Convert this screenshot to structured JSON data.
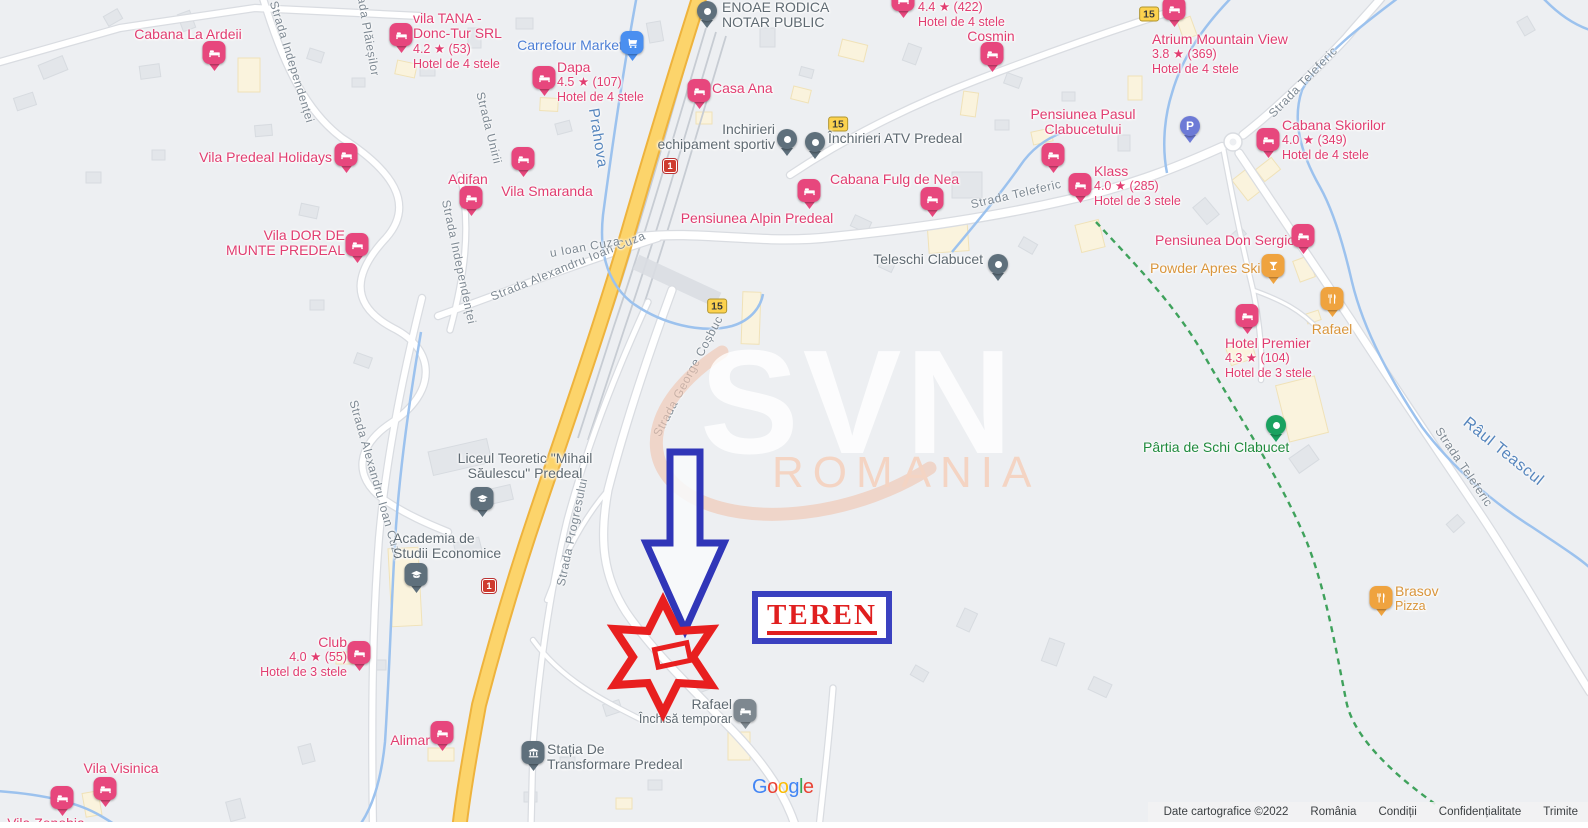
{
  "map": {
    "watermark": {
      "brand": "SVN",
      "region": "ROMANIA"
    },
    "annotation": {
      "teren_label": "TEREN"
    },
    "colors": {
      "lodging_pin": "#e7477d",
      "food_pin": "#efa33f",
      "generic_pin": "#5f707c",
      "ski_pin": "#1aa260",
      "parking_pin": "#6d7ad6",
      "supermarket_pin": "#4a8ff0",
      "lodging_label": "#e13d70",
      "food_label": "#d9953b",
      "gray_label": "#5f6a72",
      "green_label": "#1f8a3d",
      "water": "#9cc2ee",
      "highway": "#fcd46b",
      "annotation_red": "#e81f1f",
      "annotation_blue": "#3a41c0"
    },
    "pois": [
      {
        "id": "cabana-la-ardeii",
        "type": "lodging",
        "name": [
          "Cabana La Ardeii"
        ],
        "pin": [
          214,
          71
        ],
        "label": {
          "x": 188,
          "y": 27,
          "align": "center"
        }
      },
      {
        "id": "vila-tana",
        "type": "lodging",
        "name": [
          "vila TANA -",
          "Donc-Tur SRL"
        ],
        "rating": "4.2 ★ (53)",
        "subtitle": "Hotel de 4 stele",
        "pin": [
          401,
          53
        ],
        "label": {
          "x": 413,
          "y": 11,
          "align": "left"
        }
      },
      {
        "id": "carrefour-market",
        "type": "supermarket",
        "name": [
          "Carrefour Market"
        ],
        "pin": [
          632,
          61
        ],
        "label": {
          "x": 570,
          "y": 38,
          "align": "center"
        }
      },
      {
        "id": "dapa",
        "type": "lodging",
        "name": [
          "Dapa"
        ],
        "rating": "4.5 ★ (107)",
        "subtitle": "Hotel de 4 stele",
        "pin": [
          544,
          96
        ],
        "label": {
          "x": 557,
          "y": 60,
          "align": "left"
        }
      },
      {
        "id": "casa-ana",
        "type": "lodging",
        "name": [
          "Casa Ana"
        ],
        "pin": [
          699,
          109
        ],
        "label": {
          "x": 712,
          "y": 81,
          "align": "left"
        }
      },
      {
        "id": "enoae-rodica",
        "type": "generic",
        "name": [
          "ENOAE RODICA",
          "NOTAR PUBLIC"
        ],
        "pin": [
          707,
          28
        ],
        "label": {
          "x": 722,
          "y": 0,
          "align": "left"
        }
      },
      {
        "id": "hotel-422",
        "type": "lodging",
        "name": [],
        "rating": "4.4 ★ (422)",
        "subtitle": "Hotel de 4 stele",
        "pin": [
          903,
          18
        ],
        "label": {
          "x": 918,
          "y": 0,
          "align": "left"
        }
      },
      {
        "id": "cosmin",
        "type": "lodging",
        "name": [
          "Cosmin"
        ],
        "pin": [
          992,
          72
        ],
        "label": {
          "x": 991,
          "y": 29,
          "align": "center"
        }
      },
      {
        "id": "atrium-mountain-view",
        "type": "lodging",
        "name": [
          "Atrium Mountain View"
        ],
        "rating": "3.8 ★ (369)",
        "subtitle": "Hotel de 4 stele",
        "pin": [
          1174,
          27
        ],
        "label": {
          "x": 1152,
          "y": 32,
          "align": "left"
        }
      },
      {
        "id": "cabana-skiorilor",
        "type": "lodging",
        "name": [
          "Cabana Skiorilor"
        ],
        "rating": "4.0 ★ (349)",
        "subtitle": "Hotel de 4 stele",
        "pin": [
          1268,
          158
        ],
        "label": {
          "x": 1282,
          "y": 118,
          "align": "left"
        }
      },
      {
        "id": "pensiunea-pasul-clabucetului",
        "type": "lodging",
        "name": [
          "Pensiunea Pasul",
          "Clabucetului"
        ],
        "pin": [
          1053,
          173
        ],
        "label": {
          "x": 1083,
          "y": 107,
          "align": "center"
        }
      },
      {
        "id": "klass",
        "type": "lodging",
        "name": [
          "Klass"
        ],
        "rating": "4.0 ★ (285)",
        "subtitle": "Hotel de 3 stele",
        "pin": [
          1080,
          203
        ],
        "label": {
          "x": 1094,
          "y": 164,
          "align": "left"
        }
      },
      {
        "id": "parking",
        "type": "parking",
        "name": [],
        "pin": [
          1190,
          143
        ]
      },
      {
        "id": "pensiunea-don-sergio",
        "type": "lodging",
        "name": [
          "Pensiunea Don Sergio"
        ],
        "pin": [
          1303,
          254
        ],
        "label": {
          "x": 1155,
          "y": 233,
          "align": "left"
        }
      },
      {
        "id": "powder-apres-ski",
        "type": "bar",
        "name": [
          "Powder Apres Ski"
        ],
        "pin": [
          1273,
          284
        ],
        "label": {
          "x": 1150,
          "y": 261,
          "align": "left"
        }
      },
      {
        "id": "hotel-premier",
        "type": "lodging",
        "name": [
          "Hotel Premier"
        ],
        "rating": "4.3 ★ (104)",
        "subtitle": "Hotel de 3 stele",
        "pin": [
          1247,
          334
        ],
        "label": {
          "x": 1225,
          "y": 336,
          "align": "left"
        }
      },
      {
        "id": "rafael-restaurant",
        "type": "food",
        "name": [
          "Rafael"
        ],
        "pin": [
          1332,
          317
        ],
        "label": {
          "x": 1332,
          "y": 322,
          "align": "center"
        }
      },
      {
        "id": "partia-de-schi-clabucet",
        "type": "ski",
        "name": [
          "Pârtia de Schi Clabucet"
        ],
        "pin": [
          1276,
          442
        ],
        "label": {
          "x": 1143,
          "y": 440,
          "align": "left"
        }
      },
      {
        "id": "cabana-fulg-de-nea",
        "type": "lodging",
        "name": [
          "Cabana Fulg de Nea"
        ],
        "pin": [
          932,
          217
        ],
        "label": {
          "x": 830,
          "y": 172,
          "align": "left"
        }
      },
      {
        "id": "pensiunea-alpin-predeal",
        "type": "lodging",
        "name": [
          "Pensiunea Alpin Predeal"
        ],
        "pin": [
          809,
          209
        ],
        "label": {
          "x": 757,
          "y": 211,
          "align": "center"
        }
      },
      {
        "id": "inchirieri-echipament-sportiv",
        "type": "generic",
        "name": [
          "Inchirieri",
          "echipament sportiv"
        ],
        "pin": [
          787,
          156
        ],
        "label": {
          "x": 775,
          "y": 122,
          "align": "right"
        }
      },
      {
        "id": "inchirieri-atv-predeal",
        "type": "generic",
        "name": [
          "Închirieri ATV Predeal"
        ],
        "pin": [
          815,
          159
        ],
        "label": {
          "x": 828,
          "y": 131,
          "align": "left"
        }
      },
      {
        "id": "teleschi-clabucet",
        "type": "generic",
        "name": [
          "Teleschi Clabucet"
        ],
        "pin": [
          998,
          281
        ],
        "label": {
          "x": 983,
          "y": 252,
          "align": "right"
        }
      },
      {
        "id": "vila-predeal-holidays",
        "type": "lodging",
        "name": [
          "Vila Predeal Holidays"
        ],
        "pin": [
          346,
          173
        ],
        "label": {
          "x": 332,
          "y": 150,
          "align": "right"
        }
      },
      {
        "id": "adifan",
        "type": "lodging",
        "name": [
          "Adifan"
        ],
        "pin": [
          471,
          216
        ],
        "label": {
          "x": 468,
          "y": 172,
          "align": "center"
        }
      },
      {
        "id": "vila-smaranda",
        "type": "lodging",
        "name": [
          "Vila Smaranda"
        ],
        "pin": [
          523,
          177
        ],
        "label": {
          "x": 547,
          "y": 184,
          "align": "center"
        }
      },
      {
        "id": "vila-dor-de-munte",
        "type": "lodging",
        "name": [
          "Vila DOR DE",
          "MUNTE PREDEAL"
        ],
        "pin": [
          357,
          263
        ],
        "label": {
          "x": 345,
          "y": 228,
          "align": "right"
        }
      },
      {
        "id": "liceul-teoretic",
        "type": "school",
        "name": [
          "Liceul Teoretic \"Mihail",
          "Săulescu\" Predeal"
        ],
        "pin": [
          482,
          517
        ],
        "label": {
          "x": 525,
          "y": 451,
          "align": "center"
        }
      },
      {
        "id": "academia-de-studii-economice",
        "type": "school",
        "name": [
          "Academia de",
          "Studii Economice"
        ],
        "pin": [
          416,
          593
        ],
        "label": {
          "x": 393,
          "y": 531,
          "align": "left"
        }
      },
      {
        "id": "club",
        "type": "lodging",
        "name": [
          "Club"
        ],
        "rating": "4.0 ★ (55)",
        "subtitle": "Hotel de 3 stele",
        "pin": [
          359,
          671
        ],
        "label": {
          "x": 347,
          "y": 635,
          "align": "right"
        }
      },
      {
        "id": "alimar",
        "type": "lodging",
        "name": [
          "Alimar"
        ],
        "pin": [
          442,
          751
        ],
        "label": {
          "x": 430,
          "y": 733,
          "align": "right"
        }
      },
      {
        "id": "vila-visinica",
        "type": "lodging",
        "name": [
          "Vila Visinica"
        ],
        "pin": [
          105,
          807
        ],
        "label": {
          "x": 121,
          "y": 761,
          "align": "center"
        }
      },
      {
        "id": "vila-zenobia",
        "type": "lodging",
        "name": [
          "Vila Zenobia"
        ],
        "pin": [
          62,
          816
        ],
        "label": {
          "x": 46,
          "y": 816,
          "align": "center"
        }
      },
      {
        "id": "rafael-closed",
        "type": "lodging-gray",
        "name": [
          "Rafael"
        ],
        "subtitle": "Închisă temporar",
        "pin": [
          745,
          729
        ],
        "label": {
          "x": 732,
          "y": 697,
          "align": "right"
        }
      },
      {
        "id": "statia-de-transformare",
        "type": "power",
        "name": [
          "Stația De",
          "Transformare Predeal"
        ],
        "pin": [
          533,
          771
        ],
        "label": {
          "x": 547,
          "y": 742,
          "align": "left"
        }
      },
      {
        "id": "brasov-pizza",
        "type": "food",
        "name": [
          "Brasov"
        ],
        "subtitle": "Pizza",
        "pin": [
          1381,
          616
        ],
        "label": {
          "x": 1395,
          "y": 584,
          "align": "left"
        }
      }
    ],
    "street_labels": [
      {
        "text": "Strada Independenței",
        "x": 292,
        "y": 62,
        "rotate": 73
      },
      {
        "text": "Strada Plăieșilor",
        "x": 367,
        "y": 28,
        "rotate": 80
      },
      {
        "text": "Strada Unirii",
        "x": 489,
        "y": 128,
        "rotate": 76
      },
      {
        "text": "Strada Independenței",
        "x": 459,
        "y": 262,
        "rotate": 78
      },
      {
        "text": "Strada Alexandru Ioan Cuza",
        "x": 568,
        "y": 266,
        "rotate": -22
      },
      {
        "text": "Strada Alexandru Ioan Cuza",
        "x": 376,
        "y": 480,
        "rotate": 74
      },
      {
        "text": "Prahova",
        "x": 598,
        "y": 138,
        "rotate": 81,
        "water": true,
        "size": 15
      },
      {
        "text": "u Ioan Cuza",
        "x": 585,
        "y": 247,
        "rotate": -10
      },
      {
        "text": "Strada George Coșbuc",
        "x": 688,
        "y": 376,
        "rotate": -62
      },
      {
        "text": "Strada Progresului",
        "x": 572,
        "y": 532,
        "rotate": -78
      },
      {
        "text": "Strada Teleferic",
        "x": 1016,
        "y": 194,
        "rotate": -13
      },
      {
        "text": "Strada Teleferic",
        "x": 1303,
        "y": 82,
        "rotate": -46
      },
      {
        "text": "Strada Teleferic",
        "x": 1464,
        "y": 467,
        "rotate": 56
      },
      {
        "text": "Râul Teascul",
        "x": 1503,
        "y": 452,
        "rotate": 39,
        "water": true,
        "size": 16
      }
    ],
    "route_shields": [
      {
        "text": "15",
        "style": "reg",
        "x": 838,
        "y": 124
      },
      {
        "text": "15",
        "style": "reg",
        "x": 1149,
        "y": 14
      },
      {
        "text": "15",
        "style": "reg",
        "x": 717,
        "y": 306
      },
      {
        "text": "1",
        "style": "nat",
        "x": 670,
        "y": 166
      },
      {
        "text": "1",
        "style": "nat",
        "x": 489,
        "y": 586
      }
    ],
    "google_logo": [
      {
        "ch": "G",
        "c": "#4285F4"
      },
      {
        "ch": "o",
        "c": "#EA4335"
      },
      {
        "ch": "o",
        "c": "#FBBC05"
      },
      {
        "ch": "g",
        "c": "#4285F4"
      },
      {
        "ch": "l",
        "c": "#34A853"
      },
      {
        "ch": "e",
        "c": "#EA4335"
      }
    ],
    "attribution": {
      "copyright": "Date cartografice ©2022",
      "items": [
        {
          "label": "România",
          "link": false
        },
        {
          "label": "Condiții",
          "link": true
        },
        {
          "label": "Confidențialitate",
          "link": true
        },
        {
          "label": "Trimite",
          "link": true
        }
      ]
    }
  }
}
